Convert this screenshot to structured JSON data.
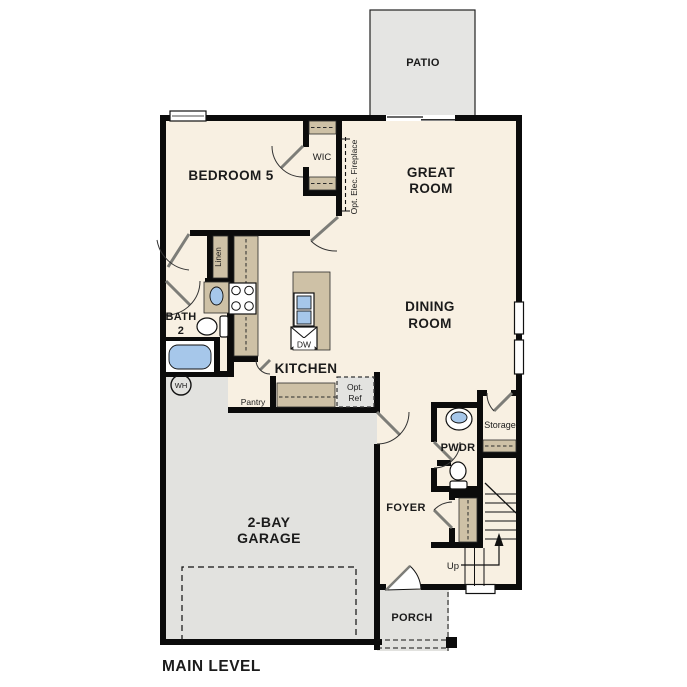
{
  "title": {
    "main_level": "MAIN LEVEL"
  },
  "rooms": {
    "patio": {
      "label": "PATIO"
    },
    "bedroom5": {
      "label": "BEDROOM 5"
    },
    "wic": {
      "label": "WIC"
    },
    "great_room": {
      "line1": "GREAT",
      "line2": "ROOM"
    },
    "dining_room": {
      "line1": "DINING",
      "line2": "ROOM"
    },
    "bath2": {
      "line1": "BATH",
      "line2": "2"
    },
    "kitchen": {
      "label": "KITCHEN"
    },
    "pantry": {
      "label": "Pantry"
    },
    "linen": {
      "label": "Linen"
    },
    "foyer": {
      "label": "FOYER"
    },
    "pwdr": {
      "label": "PWDR"
    },
    "storage": {
      "label": "Storage"
    },
    "garage": {
      "line1": "2-BAY",
      "line2": "GARAGE"
    },
    "porch": {
      "label": "PORCH"
    }
  },
  "annotations": {
    "fireplace": "Opt. Elec. Fireplace",
    "opt_ref_line1": "Opt.",
    "opt_ref_line2": "Ref",
    "dishwasher": "DW",
    "water_heater": "WH",
    "stairs_up": "Up"
  },
  "colors": {
    "interior": "#f8f0e2",
    "garage_floor": "#e2e2df",
    "patio_floor": "#e5e5e3",
    "cabinet_tan": "#cec1a6",
    "fixture_blue": "#a6c7ea",
    "wall_black": "#0b0b0b"
  }
}
